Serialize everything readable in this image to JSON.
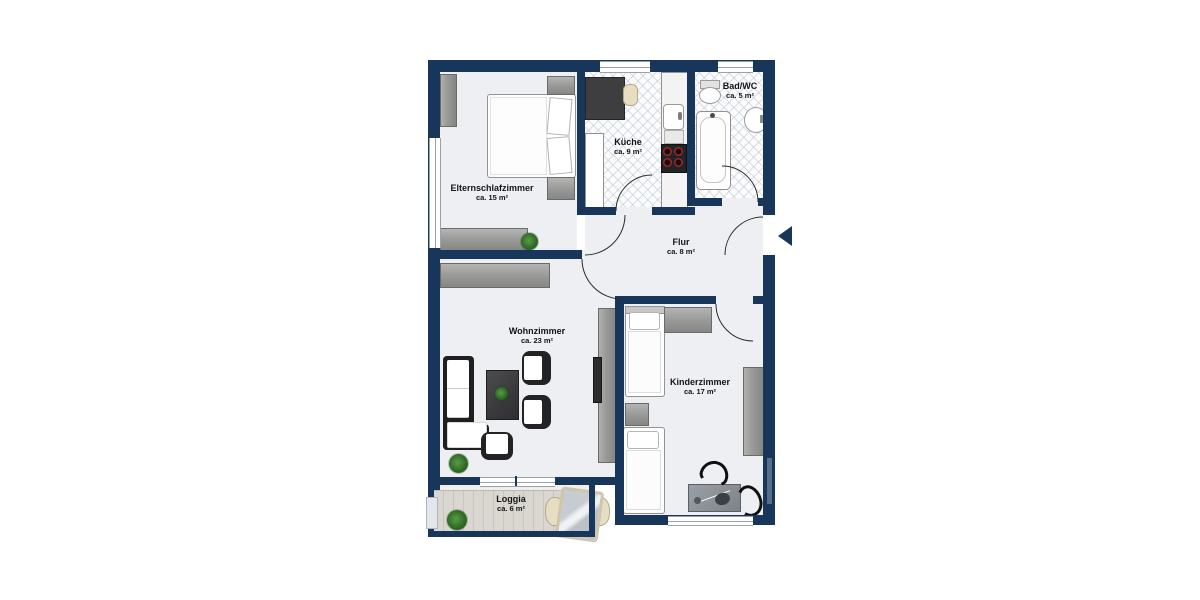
{
  "plan": {
    "type": "apartment-floor-plan",
    "rooms": [
      {
        "id": "elternschlafzimmer",
        "name": "Elternschlafzimmer",
        "area": "ca. 15 m²"
      },
      {
        "id": "kueche",
        "name": "Küche",
        "area": "ca. 9 m²"
      },
      {
        "id": "bad-wc",
        "name": "Bad/WC",
        "area": "ca. 5 m²"
      },
      {
        "id": "flur",
        "name": "Flur",
        "area": "ca. 8 m²"
      },
      {
        "id": "wohnzimmer",
        "name": "Wohnzimmer",
        "area": "ca. 23 m²"
      },
      {
        "id": "kinderzimmer",
        "name": "Kinderzimmer",
        "area": "ca. 17 m²"
      },
      {
        "id": "loggia",
        "name": "Loggia",
        "area": "ca. 6 m²"
      }
    ],
    "entrance": {
      "symbol": "arrow-left"
    },
    "colors": {
      "wall": "#18365a",
      "floor": "#edeff2",
      "wood": "#d8d4ce",
      "plant_green": "#2f6d27",
      "text": "#141417"
    }
  }
}
